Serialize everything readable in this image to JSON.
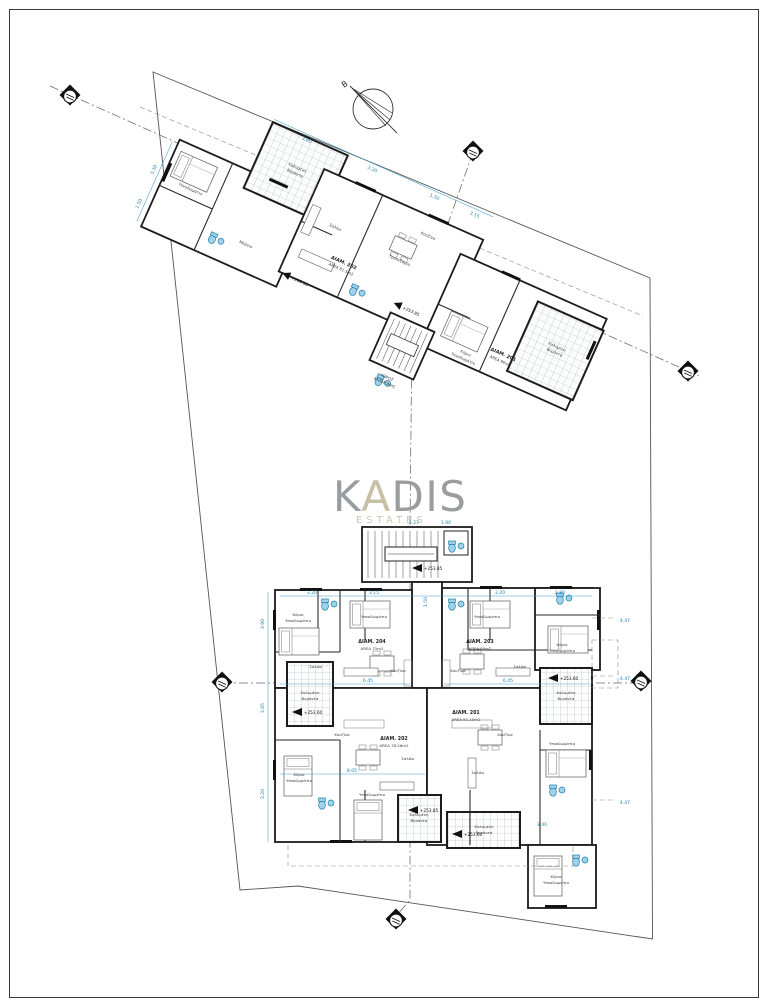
{
  "watermark": {
    "k": "K",
    "a": "A",
    "dis": "DIS",
    "subtitle": "ESTATES",
    "color_gray": "#9a9da0",
    "color_beige": "#c8bfa6",
    "color_sub": "#cdc6b4"
  },
  "compass": {
    "label": "B"
  },
  "apartments": {
    "a204": {
      "id": "ΔΙΑΜ. 204",
      "area": "AREA 75m2"
    },
    "a203": {
      "id": "ΔΙΑΜ. 203",
      "area": "AREA 80m2"
    },
    "a202": {
      "id": "ΔΙΑΜ. 202",
      "area": "AREA 78.26m2"
    },
    "a201": {
      "id": "ΔΙΑΜ. 201",
      "area": "AREA 81.15m2"
    }
  },
  "top_apartments": {
    "left": {
      "id": "ΔΙΑΜ. 202",
      "area": "AREA 81.5m2"
    },
    "right": {
      "id": "ΔΙΑΜ. 201",
      "area": "AREA 80m2"
    }
  },
  "rooms": {
    "master1": "Κύριο",
    "master2": "Υπνοδωμάτιο",
    "bedroom": "Υπνοδωμάτιο",
    "living": "Σαλόνι",
    "kitchen": "Κουζίνα",
    "dining": "Τραπεζαρία",
    "bath": "Μπάνιο",
    "veranda1": "Καλυμένη",
    "veranda2": "Βεράντα",
    "hall1": "ΧΩΡΟΣ",
    "hall2": "ΑΝΑΜΟΝΗΣ"
  },
  "dims": {
    "d380": "3.80",
    "d390": "3.90",
    "d320": "3.20",
    "d315": "3.15",
    "d150": "1.50",
    "d645": "6.45",
    "d805": "8.05",
    "d280": "2.80",
    "d447": "4.47",
    "d365": "3.65",
    "d127": "1.27",
    "d340": "3.40",
    "d330": "3.30",
    "d190": "1.90"
  },
  "elevations": {
    "e1": "+253.85",
    "e2": "+253.60"
  },
  "colors": {
    "dim_blue": "#3f9fc8",
    "fixture_blue": "#9fd2e8",
    "wall": "#1c1c1c"
  }
}
